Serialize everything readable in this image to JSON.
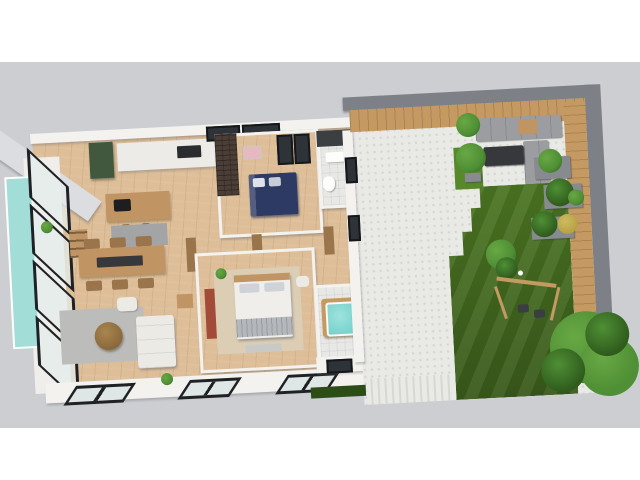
{
  "scene": {
    "type": "3d-floor-plan-render",
    "view": "tilted top-down axonometric house plan with right-side garden",
    "canvas_width": 640,
    "canvas_height": 480,
    "letterbox": "white bands above and below a light gray backdrop"
  },
  "palette": {
    "backdrop": "#cdced2",
    "white": "#ffffff",
    "wall_white": "#f3f2ef",
    "wall_shade": "#b9babd",
    "slab_gray": "#dcdde0",
    "wood_floor": "#ddbe98",
    "wood_mid": "#c09463",
    "wood_deck": "#c49a62",
    "wood_dark": "#9a744a",
    "frame_black": "#202124",
    "glass": "#dfe7e6",
    "pool_teal": "#a2ddd8",
    "tub_teal": "#6fd0ca",
    "counter_white": "#ecebe7",
    "cabinet_green": "#41583f",
    "bed_navy": "#2d3a64",
    "accent_red": "#a34b39",
    "art_yellow": "#e3b33c",
    "desk_pink": "#e9bcc4",
    "pink_art": "#e7b8c0",
    "teal_bed": "#7fc8c2",
    "rug_gray": "#a2a4a5",
    "rug_light": "#bcbdba",
    "rug_beige": "#dccdb5",
    "sofa_white": "#eceae5",
    "dark_band": "#7d8086",
    "gray_wall": "#878a8f",
    "paving": "#e9e9e6",
    "tile": "#e8e9e7",
    "lawn": "#4b7522",
    "lawn_dark": "#39591b",
    "grass_bright": "#57882c",
    "plant": "#4f8f35",
    "plant_dark": "#2f5c1d",
    "plant_light": "#68a844",
    "gold_shrub": "#b7a144",
    "sofa_outdoor": "#9b9da1",
    "table_dark": "#36383c",
    "brick_dark": "#4a3e36",
    "hedge": "#2d4d17"
  },
  "regions": [
    {
      "name": "pool",
      "desc": "narrow teal water strip along the far left glass wall"
    },
    {
      "name": "open-plan-area",
      "desc": "kitchen with dark green cabinet and island with sink and stools, six-seat dining table with dark runner, gray rugs, white corner sofa, round coffee table, terracotta tv panel"
    },
    {
      "name": "bedroom-navy",
      "desc": "double bed with navy bedding, dark brick accent wall, pink artwork, two dark window panes"
    },
    {
      "name": "bathroom-shower",
      "desc": "white bathroom with dark mosaic wall band, sink and toilet"
    },
    {
      "name": "master-bedroom",
      "desc": "upholstered double bed on beige rug with bench and terracotta wardrobe panel"
    },
    {
      "name": "bathroom-spa",
      "desc": "wood-clad jacuzzi tub with teal water, toilet, tiled floor"
    },
    {
      "name": "bedroom-teal",
      "desc": "single bed with teal frame, yellow diamond wall art, desk with black chair, wood wardrobe"
    },
    {
      "name": "study",
      "desc": "pink desk with chair"
    },
    {
      "name": "hallway",
      "desc": "wood corridor with oak doors and wardrobes"
    },
    {
      "name": "terrace",
      "desc": "outdoor lounge with gray sofas, dark coffee table, potted trees and bright grass patch"
    },
    {
      "name": "garden",
      "desc": "stepped striped lawn, gray planters with shrubs, wooden swing, white ball, tree with circular wood bench, wood deck rim and dark gray boundary wall, gravel path and hedge"
    }
  ]
}
